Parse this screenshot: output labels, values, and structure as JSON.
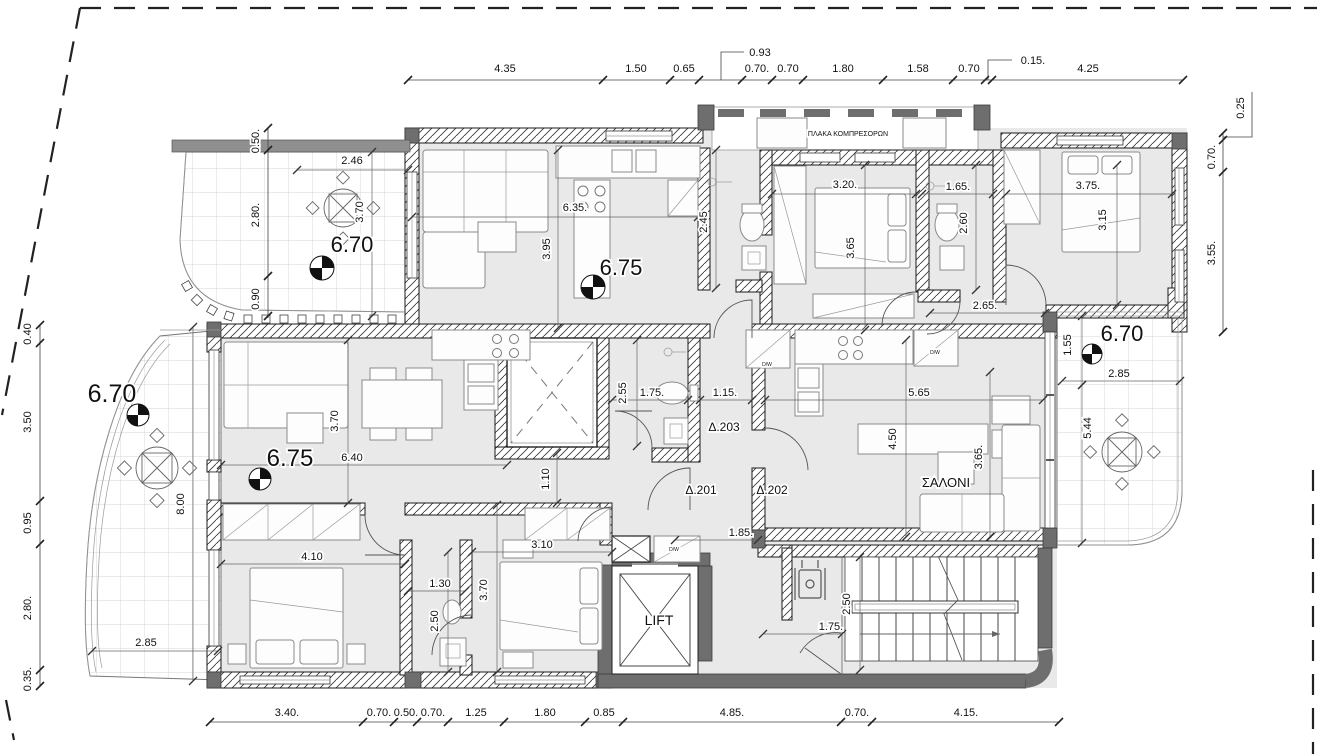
{
  "drawing_type": "architectural-floor-plan",
  "colors": {
    "floor": "#e9e9e9",
    "wall_dark": "#6e6e6e",
    "line": "#1a1a1a",
    "tile_line": "#c9c9c9"
  },
  "levels": [
    {
      "text": "6.70",
      "x": 352,
      "y": 252,
      "size": 22,
      "cx": 322,
      "cy": 268,
      "r": 12
    },
    {
      "text": "6.75",
      "x": 621,
      "y": 275,
      "size": 22,
      "cx": 593,
      "cy": 287,
      "r": 12
    },
    {
      "text": "6.70",
      "x": 112,
      "y": 402,
      "size": 25,
      "cx": 138,
      "cy": 415,
      "r": 11
    },
    {
      "text": "6.75",
      "x": 290,
      "y": 466,
      "size": 24,
      "cx": 260,
      "cy": 479,
      "r": 11
    },
    {
      "text": "6.70",
      "x": 1122,
      "y": 341,
      "size": 22,
      "cx": 1092,
      "cy": 354,
      "r": 10
    }
  ],
  "room_labels": [
    {
      "text": "ΣΑΛΟΝΙ",
      "x": 946,
      "y": 487,
      "size": 13
    },
    {
      "text": "LIFT",
      "x": 659,
      "y": 625,
      "size": 14
    },
    {
      "text": "ΠΛΑΚΑ ΚΟΜΠΡΕΣΟΡΩΝ",
      "x": 848,
      "y": 136,
      "size": 7
    },
    {
      "text": "Δ.201",
      "x": 701,
      "y": 494,
      "size": 12
    },
    {
      "text": "Δ.202",
      "x": 772,
      "y": 494,
      "size": 12
    },
    {
      "text": "Δ.203",
      "x": 724,
      "y": 431,
      "size": 12
    },
    {
      "text": "D/W",
      "x": 767,
      "y": 366,
      "size": 5
    },
    {
      "text": "D/W",
      "x": 935,
      "y": 354,
      "size": 5
    },
    {
      "text": "D/W",
      "x": 674,
      "y": 551,
      "size": 5
    }
  ],
  "dimensions": [
    {
      "text": "4.35",
      "x": 505,
      "y": 72,
      "rot": 0
    },
    {
      "text": "1.50",
      "x": 636,
      "y": 72,
      "rot": 0
    },
    {
      "text": "0.65",
      "x": 684,
      "y": 72,
      "rot": 0
    },
    {
      "text": "0.93",
      "x": 760,
      "y": 56,
      "rot": 0
    },
    {
      "text": "0.70.",
      "x": 757,
      "y": 72,
      "rot": 0
    },
    {
      "text": "0.70",
      "x": 788,
      "y": 72,
      "rot": 0
    },
    {
      "text": "1.80",
      "x": 843,
      "y": 72,
      "rot": 0
    },
    {
      "text": "1.58",
      "x": 918,
      "y": 72,
      "rot": 0
    },
    {
      "text": "0.70",
      "x": 969,
      "y": 72,
      "rot": 0
    },
    {
      "text": "0.15.",
      "x": 1033,
      "y": 64,
      "rot": 0
    },
    {
      "text": "4.25",
      "x": 1088,
      "y": 72,
      "rot": 0
    },
    {
      "text": "0.25",
      "x": 1244,
      "y": 108,
      "rot": -90
    },
    {
      "text": "0.70.",
      "x": 1215,
      "y": 157,
      "rot": -90
    },
    {
      "text": "3.55.",
      "x": 1215,
      "y": 253,
      "rot": -90
    },
    {
      "text": "0.50.",
      "x": 259,
      "y": 141,
      "rot": -90
    },
    {
      "text": "2.80.",
      "x": 259,
      "y": 215,
      "rot": -90
    },
    {
      "text": "0.90",
      "x": 259,
      "y": 299,
      "rot": -90
    },
    {
      "text": "0.40",
      "x": 31,
      "y": 334,
      "rot": -90
    },
    {
      "text": "3.50",
      "x": 31,
      "y": 422,
      "rot": -90
    },
    {
      "text": "0.95",
      "x": 31,
      "y": 523,
      "rot": -90
    },
    {
      "text": "2.80.",
      "x": 31,
      "y": 608,
      "rot": -90
    },
    {
      "text": "0.35.",
      "x": 31,
      "y": 679,
      "rot": -90
    },
    {
      "text": "3.40.",
      "x": 287,
      "y": 716,
      "rot": 0
    },
    {
      "text": "0.70.",
      "x": 379,
      "y": 716,
      "rot": 0
    },
    {
      "text": "0.50.",
      "x": 406,
      "y": 716,
      "rot": 0
    },
    {
      "text": "0.70.",
      "x": 433,
      "y": 716,
      "rot": 0
    },
    {
      "text": "1.25",
      "x": 476,
      "y": 716,
      "rot": 0
    },
    {
      "text": "1.80",
      "x": 545,
      "y": 716,
      "rot": 0
    },
    {
      "text": "0.85",
      "x": 604,
      "y": 716,
      "rot": 0
    },
    {
      "text": "4.85.",
      "x": 732,
      "y": 716,
      "rot": 0
    },
    {
      "text": "0.70.",
      "x": 857,
      "y": 716,
      "rot": 0
    },
    {
      "text": "4.15.",
      "x": 966,
      "y": 716,
      "rot": 0
    },
    {
      "text": "2.46",
      "x": 352,
      "y": 164,
      "rot": 0
    },
    {
      "text": "3.70",
      "x": 363,
      "y": 212,
      "rot": -90
    },
    {
      "text": "6.35.",
      "x": 575,
      "y": 211,
      "rot": 0
    },
    {
      "text": "3.95",
      "x": 550,
      "y": 249,
      "rot": -90
    },
    {
      "text": "2.45",
      "x": 707,
      "y": 222,
      "rot": -90
    },
    {
      "text": "3.20.",
      "x": 845,
      "y": 188,
      "rot": 0
    },
    {
      "text": "3.65",
      "x": 854,
      "y": 248,
      "rot": -90
    },
    {
      "text": "1.65.",
      "x": 958,
      "y": 190,
      "rot": 0
    },
    {
      "text": "2.60",
      "x": 967,
      "y": 223,
      "rot": -90
    },
    {
      "text": "3.75.",
      "x": 1088,
      "y": 189,
      "rot": 0
    },
    {
      "text": "3.15",
      "x": 1106,
      "y": 220,
      "rot": -90
    },
    {
      "text": "2.65.",
      "x": 985,
      "y": 309,
      "rot": 0
    },
    {
      "text": "1.55",
      "x": 1071,
      "y": 345,
      "rot": -90
    },
    {
      "text": "2.85",
      "x": 1119,
      "y": 377,
      "rot": 0
    },
    {
      "text": "5.44",
      "x": 1091,
      "y": 428,
      "rot": -90
    },
    {
      "text": "3.70",
      "x": 338,
      "y": 421,
      "rot": -90
    },
    {
      "text": "6.40",
      "x": 352,
      "y": 461,
      "rot": 0
    },
    {
      "text": "8.00",
      "x": 184,
      "y": 504,
      "rot": -90
    },
    {
      "text": "2.85",
      "x": 146,
      "y": 646,
      "rot": 0
    },
    {
      "text": "2.55",
      "x": 626,
      "y": 393,
      "rot": -90
    },
    {
      "text": "1.75.",
      "x": 652,
      "y": 396,
      "rot": 0
    },
    {
      "text": "1.15.",
      "x": 725,
      "y": 396,
      "rot": 0
    },
    {
      "text": "5.65",
      "x": 919,
      "y": 396,
      "rot": 0
    },
    {
      "text": "4.50",
      "x": 896,
      "y": 439,
      "rot": -90
    },
    {
      "text": "3.65.",
      "x": 982,
      "y": 457,
      "rot": -90
    },
    {
      "text": "1.10",
      "x": 549,
      "y": 479,
      "rot": -90
    },
    {
      "text": "1.85.",
      "x": 741,
      "y": 536,
      "rot": 0
    },
    {
      "text": "4.10",
      "x": 312,
      "y": 560,
      "rot": 0
    },
    {
      "text": "1.30",
      "x": 440,
      "y": 587,
      "rot": 0
    },
    {
      "text": "2.50",
      "x": 438,
      "y": 621,
      "rot": -90
    },
    {
      "text": "3.10",
      "x": 542,
      "y": 548,
      "rot": 0
    },
    {
      "text": "3.70",
      "x": 487,
      "y": 590,
      "rot": -90
    },
    {
      "text": "2.50",
      "x": 850,
      "y": 604,
      "rot": -90
    },
    {
      "text": "1.75.",
      "x": 831,
      "y": 630,
      "rot": 0
    }
  ],
  "dim_chains": [
    {
      "x1": 408,
      "y1": 80,
      "x2": 1183,
      "y2": 80,
      "ticks_x": [
        408,
        603,
        670,
        699,
        742,
        772,
        803,
        883,
        953,
        985,
        992,
        1183
      ],
      "ticks_y": [
        80
      ]
    },
    {
      "x1": 210,
      "y1": 722,
      "x2": 1059,
      "y2": 722,
      "ticks_x": [
        210,
        363,
        394,
        417,
        448,
        504,
        585,
        623,
        841,
        872,
        1059
      ],
      "ticks_y": [
        722
      ]
    },
    {
      "x1": 40,
      "y1": 325,
      "x2": 40,
      "y2": 686,
      "ticks_x": [
        40
      ],
      "ticks_y": [
        325,
        343,
        501,
        544,
        670,
        686
      ]
    },
    {
      "x1": 268,
      "y1": 128,
      "x2": 268,
      "y2": 318,
      "ticks_x": [
        268
      ],
      "ticks_y": [
        128,
        150,
        276,
        316
      ]
    },
    {
      "x1": 1223,
      "y1": 133,
      "x2": 1223,
      "y2": 332,
      "ticks_x": [
        1223
      ],
      "ticks_y": [
        133,
        140,
        172,
        332
      ]
    }
  ],
  "dim_lines": [
    {
      "x1": 297,
      "y1": 170,
      "x2": 408,
      "y2": 170
    },
    {
      "x1": 372,
      "y1": 152,
      "x2": 372,
      "y2": 316
    },
    {
      "x1": 412,
      "y1": 217,
      "x2": 698,
      "y2": 217
    },
    {
      "x1": 558,
      "y1": 150,
      "x2": 558,
      "y2": 328
    },
    {
      "x1": 716,
      "y1": 150,
      "x2": 716,
      "y2": 288
    },
    {
      "x1": 772,
      "y1": 194,
      "x2": 916,
      "y2": 194
    },
    {
      "x1": 865,
      "y1": 165,
      "x2": 865,
      "y2": 330
    },
    {
      "x1": 922,
      "y1": 194,
      "x2": 993,
      "y2": 194
    },
    {
      "x1": 976,
      "y1": 165,
      "x2": 976,
      "y2": 290
    },
    {
      "x1": 1006,
      "y1": 194,
      "x2": 1172,
      "y2": 194
    },
    {
      "x1": 1117,
      "y1": 165,
      "x2": 1117,
      "y2": 305
    },
    {
      "x1": 930,
      "y1": 313,
      "x2": 1045,
      "y2": 313
    },
    {
      "x1": 1082,
      "y1": 316,
      "x2": 1082,
      "y2": 385
    },
    {
      "x1": 1062,
      "y1": 381,
      "x2": 1180,
      "y2": 381
    },
    {
      "x1": 1082,
      "y1": 385,
      "x2": 1082,
      "y2": 543
    },
    {
      "x1": 348,
      "y1": 340,
      "x2": 348,
      "y2": 503
    },
    {
      "x1": 221,
      "y1": 465,
      "x2": 507,
      "y2": 465
    },
    {
      "x1": 193,
      "y1": 327,
      "x2": 193,
      "y2": 681
    },
    {
      "x1": 92,
      "y1": 651,
      "x2": 218,
      "y2": 651
    },
    {
      "x1": 637,
      "y1": 340,
      "x2": 637,
      "y2": 446
    },
    {
      "x1": 612,
      "y1": 400,
      "x2": 688,
      "y2": 400
    },
    {
      "x1": 700,
      "y1": 400,
      "x2": 752,
      "y2": 400
    },
    {
      "x1": 765,
      "y1": 400,
      "x2": 1043,
      "y2": 400
    },
    {
      "x1": 906,
      "y1": 340,
      "x2": 906,
      "y2": 537
    },
    {
      "x1": 990,
      "y1": 372,
      "x2": 990,
      "y2": 537
    },
    {
      "x1": 557,
      "y1": 453,
      "x2": 557,
      "y2": 503
    },
    {
      "x1": 675,
      "y1": 540,
      "x2": 758,
      "y2": 540
    },
    {
      "x1": 221,
      "y1": 564,
      "x2": 405,
      "y2": 564
    },
    {
      "x1": 408,
      "y1": 591,
      "x2": 465,
      "y2": 591
    },
    {
      "x1": 448,
      "y1": 552,
      "x2": 448,
      "y2": 672
    },
    {
      "x1": 472,
      "y1": 552,
      "x2": 612,
      "y2": 552
    },
    {
      "x1": 497,
      "y1": 505,
      "x2": 497,
      "y2": 672
    },
    {
      "x1": 860,
      "y1": 557,
      "x2": 860,
      "y2": 670
    },
    {
      "x1": 763,
      "y1": 634,
      "x2": 842,
      "y2": 634
    }
  ]
}
